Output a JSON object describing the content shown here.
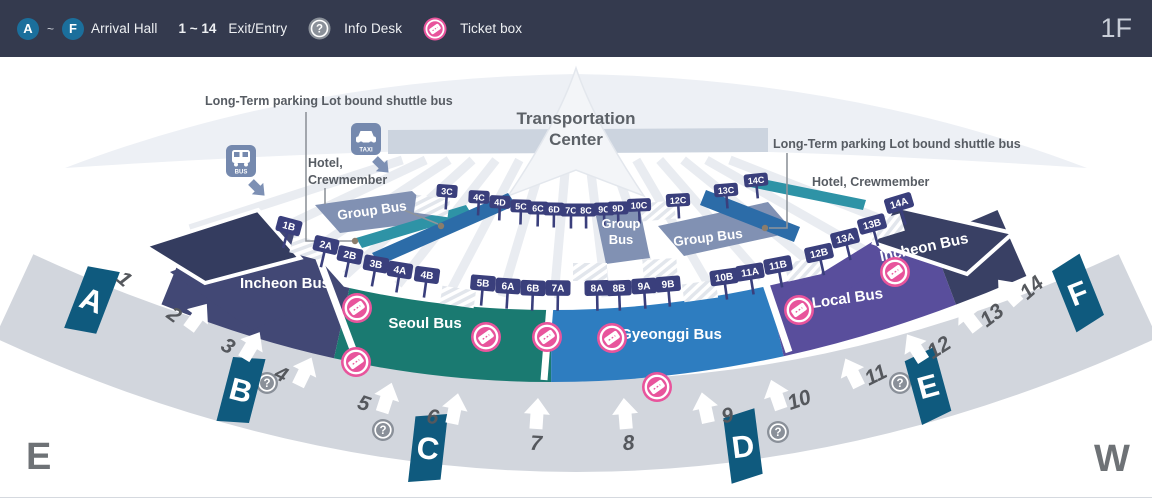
{
  "header": {
    "arrival_start": "A",
    "tilde": "~",
    "arrival_end": "F",
    "arrival_label": "Arrival Hall",
    "exit_range": "1 ~ 14",
    "exit_label": "Exit/Entry",
    "info_label": "Info Desk",
    "ticket_label": "Ticket box",
    "floor": "1F"
  },
  "map": {
    "title_lines": [
      "Transportation",
      "Center"
    ],
    "long_term_left": "Long-Term parking Lot bound shuttle bus",
    "long_term_right": "Long-Term parking Lot bound shuttle bus",
    "hotel_left_lines": [
      "Hotel,",
      "Crewmember"
    ],
    "hotel_right": "Hotel, Crewmember",
    "bus_icon_label": "BUS",
    "taxi_icon_label": "TAXI",
    "east_label": "E",
    "west_label": "W",
    "zones": [
      {
        "id": "incheon-left",
        "label": "Incheon Bus",
        "color": "#424875",
        "label_x": 285,
        "label_y": 288,
        "label_rot": 0,
        "seg_start": 0,
        "seg_len": 203
      },
      {
        "id": "seoul",
        "label": "Seoul Bus",
        "color": "#1a7a71",
        "label_x": 425,
        "label_y": 328,
        "label_rot": 0,
        "seg_start": 203,
        "seg_len": 245
      },
      {
        "id": "gyeonggi",
        "label": "Gyeonggi Bus",
        "color": "#2e7dc0",
        "label_x": 671,
        "label_y": 339,
        "label_rot": 0,
        "seg_start": 448,
        "seg_len": 263
      },
      {
        "id": "local",
        "label": "Local Bus",
        "color": "#594e9c",
        "label_x": 848,
        "label_y": 303,
        "label_rot": -8,
        "seg_start": 711,
        "seg_len": 203
      },
      {
        "id": "incheon-right",
        "label": "Incheon Bus",
        "color": "#394064",
        "label_x": 925,
        "label_y": 252,
        "label_rot": -12,
        "seg_start": 914,
        "seg_len": 86
      }
    ],
    "group_bus_labels": [
      {
        "id": "group-bus-left",
        "label": "Group Bus",
        "x": 372,
        "y": 211,
        "rot": -8,
        "two_line": false
      },
      {
        "id": "group-bus-center",
        "label": "Group Bus",
        "x": 621,
        "y": 228,
        "rot": 0,
        "two_line": true
      },
      {
        "id": "group-bus-right",
        "label": "Group Bus",
        "x": 708,
        "y": 238,
        "rot": -7,
        "two_line": false
      }
    ],
    "stops_top": [
      [
        "3C",
        447,
        191
      ],
      [
        "4C",
        479,
        197
      ],
      [
        "4D",
        500,
        202
      ],
      [
        "5C",
        521,
        206
      ],
      [
        "6C",
        538,
        208
      ],
      [
        "6D",
        554,
        209
      ],
      [
        "7C",
        571,
        210
      ],
      [
        "8C",
        586,
        210
      ],
      [
        "9C",
        604,
        209
      ],
      [
        "9D",
        618,
        208
      ],
      [
        "10C",
        639,
        205
      ],
      [
        "12C",
        678,
        200
      ],
      [
        "13C",
        726,
        190
      ],
      [
        "14C",
        756,
        180
      ]
    ],
    "stops_main": [
      [
        "1B",
        289,
        226
      ],
      [
        "2A",
        326,
        245
      ],
      [
        "2B",
        350,
        255
      ],
      [
        "3B",
        376,
        264
      ],
      [
        "4A",
        400,
        270
      ],
      [
        "4B",
        427,
        275
      ],
      [
        "5B",
        483,
        283
      ],
      [
        "6A",
        508,
        286
      ],
      [
        "6B",
        533,
        288
      ],
      [
        "7A",
        558,
        288
      ],
      [
        "8A",
        597,
        288
      ],
      [
        "8B",
        619,
        288
      ],
      [
        "9A",
        644,
        286
      ],
      [
        "9B",
        668,
        284
      ],
      [
        "10B",
        724,
        277
      ],
      [
        "11A",
        750,
        272
      ],
      [
        "11B",
        778,
        265
      ],
      [
        "12B",
        819,
        253
      ],
      [
        "13A",
        845,
        238
      ],
      [
        "13B",
        872,
        224
      ],
      [
        "14A",
        899,
        203
      ]
    ],
    "exits": [
      [
        "1",
        148,
        282
      ],
      [
        "2",
        198,
        316
      ],
      [
        "3",
        252,
        345
      ],
      [
        "4",
        305,
        371
      ],
      [
        "5",
        387,
        397
      ],
      [
        "6",
        455,
        408
      ],
      [
        "7",
        537,
        413
      ],
      [
        "8",
        625,
        413
      ],
      [
        "9",
        705,
        407
      ],
      [
        "10",
        776,
        394
      ],
      [
        "11",
        852,
        372
      ],
      [
        "12",
        915,
        347
      ],
      [
        "13",
        968,
        317
      ],
      [
        "14",
        1008,
        291
      ]
    ],
    "gates": [
      [
        "A",
        92,
        300
      ],
      [
        "B",
        241,
        390
      ],
      [
        "C",
        428,
        448
      ],
      [
        "D",
        743,
        446
      ],
      [
        "E",
        928,
        386
      ],
      [
        "F",
        1078,
        293
      ]
    ],
    "info_points": [
      [
        267,
        383
      ],
      [
        383,
        430
      ],
      [
        778,
        432
      ],
      [
        900,
        383
      ]
    ],
    "ticket_points": [
      [
        357,
        308
      ],
      [
        486,
        337
      ],
      [
        547,
        337
      ],
      [
        612,
        338
      ],
      [
        356,
        362
      ],
      [
        657,
        387
      ],
      [
        799,
        310
      ],
      [
        895,
        272
      ]
    ]
  },
  "colors": {
    "header_bg": "#343a4e",
    "badge_blue": "#1b6f9c",
    "ticket_pink": "#e8549c",
    "info_gray": "#8a9099",
    "sign_navy": "#3a3f7c",
    "gate_teal": "#0f5a7e",
    "curb_band": "#d2d6dd",
    "wing_navy": "#343c5f",
    "island_bluegray": "#8191b3",
    "stripe_teal": "#2e93a6",
    "stripe_blue": "#2c6ca8",
    "label_gray": "#575c63",
    "big_letter_gray": "#6e7276",
    "floor_text": "#c9ced8",
    "arrow_num": "#55585d",
    "building_fill": "#edf0f5",
    "building_band": "#ccd4df"
  }
}
